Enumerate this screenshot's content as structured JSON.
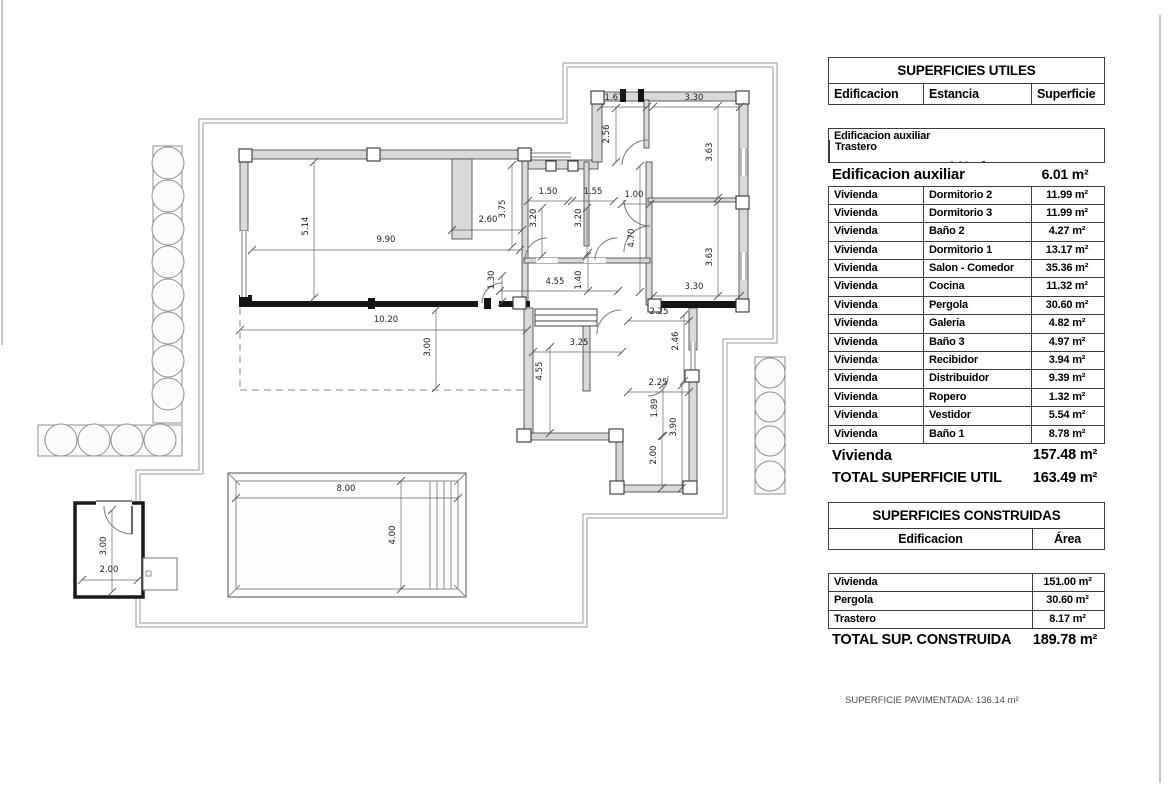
{
  "plan": {
    "dimensions": [
      {
        "t": "1.67",
        "x": 614,
        "y": 100,
        "r": 0,
        "line": [
          601,
          107,
          647,
          107
        ]
      },
      {
        "t": "3.30",
        "x": 694,
        "y": 100,
        "r": 0,
        "line": [
          653,
          107,
          740,
          107
        ]
      },
      {
        "t": "2.56",
        "x": 609,
        "y": 134,
        "r": 90,
        "line": [
          616,
          108,
          616,
          162
        ]
      },
      {
        "t": "3.63",
        "x": 712,
        "y": 152,
        "r": 90,
        "line": [
          718,
          106,
          718,
          198
        ]
      },
      {
        "t": "1.50",
        "x": 548,
        "y": 194,
        "r": 0,
        "line": [
          528,
          201,
          568,
          201
        ]
      },
      {
        "t": "1.55",
        "x": 593,
        "y": 194,
        "r": 0,
        "line": [
          572,
          201,
          614,
          201
        ]
      },
      {
        "t": "1.00",
        "x": 634,
        "y": 197,
        "r": 0,
        "line": [
          622,
          204,
          650,
          204
        ]
      },
      {
        "t": "3.75",
        "x": 505,
        "y": 209,
        "r": 90,
        "line": [
          512,
          165,
          512,
          247
        ]
      },
      {
        "t": "3.20",
        "x": 536,
        "y": 218,
        "r": 90,
        "line": [
          542,
          208,
          542,
          256
        ]
      },
      {
        "t": "3.20",
        "x": 581,
        "y": 218,
        "r": 90,
        "line": [
          587,
          208,
          587,
          256
        ]
      },
      {
        "t": "2.60",
        "x": 488,
        "y": 222,
        "r": 0,
        "line": [
          452,
          230,
          522,
          230
        ]
      },
      {
        "t": "5.14",
        "x": 308,
        "y": 226,
        "r": 90,
        "line": [
          314,
          162,
          314,
          298
        ]
      },
      {
        "t": "4.70",
        "x": 634,
        "y": 238,
        "r": 90,
        "line": [
          640,
          166,
          640,
          292
        ]
      },
      {
        "t": "9.90",
        "x": 386,
        "y": 242,
        "r": 0,
        "line": [
          252,
          250,
          520,
          250
        ]
      },
      {
        "t": "3.63",
        "x": 712,
        "y": 257,
        "r": 90,
        "line": [
          718,
          202,
          718,
          296
        ]
      },
      {
        "t": "1.30",
        "x": 494,
        "y": 280,
        "r": 90,
        "line": [
          502,
          276,
          502,
          302
        ]
      },
      {
        "t": "4.55",
        "x": 555,
        "y": 284,
        "r": 0,
        "line": [
          500,
          291,
          618,
          291
        ]
      },
      {
        "t": "1.40",
        "x": 581,
        "y": 280,
        "r": 90,
        "line": [
          588,
          253,
          588,
          291
        ]
      },
      {
        "t": "3.30",
        "x": 694,
        "y": 289,
        "r": 0,
        "line": [
          653,
          296,
          740,
          296
        ]
      },
      {
        "t": "10.20",
        "x": 386,
        "y": 322,
        "r": 0,
        "line": [
          240,
          330,
          527,
          330
        ]
      },
      {
        "t": "2.25",
        "x": 659,
        "y": 314,
        "r": 0,
        "line": [
          628,
          321,
          689,
          321
        ]
      },
      {
        "t": "3.00",
        "x": 430,
        "y": 347,
        "r": 90,
        "line": [
          436,
          310,
          436,
          388
        ]
      },
      {
        "t": "2.46",
        "x": 678,
        "y": 341,
        "r": 90,
        "line": [
          684,
          315,
          684,
          381
        ]
      },
      {
        "t": "3.25",
        "x": 579,
        "y": 345,
        "r": 0,
        "line": [
          533,
          352,
          622,
          352
        ]
      },
      {
        "t": "4.55",
        "x": 542,
        "y": 371,
        "r": 90,
        "line": [
          550,
          347,
          550,
          433
        ]
      },
      {
        "t": "2.25",
        "x": 658,
        "y": 385,
        "r": 0,
        "line": [
          628,
          392,
          689,
          392
        ]
      },
      {
        "t": "1.89",
        "x": 657,
        "y": 408,
        "r": 90,
        "line": [
          663,
          385,
          663,
          436
        ]
      },
      {
        "t": "3.90",
        "x": 676,
        "y": 427,
        "r": 90,
        "line": [
          682,
          385,
          682,
          488
        ]
      },
      {
        "t": "2.00",
        "x": 656,
        "y": 455,
        "r": 90,
        "line": [
          662,
          436,
          662,
          488
        ]
      },
      {
        "t": "8.00",
        "x": 346,
        "y": 491,
        "r": 0,
        "line": [
          236,
          498,
          458,
          498
        ]
      },
      {
        "t": "4.00",
        "x": 395,
        "y": 535,
        "r": 90,
        "line": [
          401,
          481,
          401,
          589
        ]
      },
      {
        "t": "3.00",
        "x": 106,
        "y": 546,
        "r": 90,
        "line": [
          112,
          510,
          112,
          592
        ]
      },
      {
        "t": "2.00",
        "x": 109,
        "y": 572,
        "r": 0,
        "line": [
          82,
          580,
          138,
          580
        ]
      }
    ]
  },
  "tables": {
    "utiles": {
      "title": "SUPERFICIES UTILES",
      "columns": [
        "Edificacion",
        "Estancia",
        "Superficie"
      ],
      "aux_row": {
        "edificacion": "Edificacion auxiliar",
        "estancia": "Trastero",
        "superficie": "6.01 m²"
      },
      "aux_subtotal": {
        "label": "Edificacion auxiliar",
        "value": "6.01 m²"
      },
      "rows": [
        {
          "edificacion": "Vivienda",
          "estancia": "Dormitorio 2",
          "superficie": "11.99 m²"
        },
        {
          "edificacion": "Vivienda",
          "estancia": "Dormitorio 3",
          "superficie": "11.99 m²"
        },
        {
          "edificacion": "Vivienda",
          "estancia": "Baño 2",
          "superficie": "4.27 m²"
        },
        {
          "edificacion": "Vivienda",
          "estancia": "Dormitorio 1",
          "superficie": "13.17 m²"
        },
        {
          "edificacion": "Vivienda",
          "estancia": "Salon  - Comedor",
          "superficie": "35.36 m²"
        },
        {
          "edificacion": "Vivienda",
          "estancia": "Cocina",
          "superficie": "11.32 m²"
        },
        {
          "edificacion": "Vivienda",
          "estancia": "Pergola",
          "superficie": "30.60 m²"
        },
        {
          "edificacion": "Vivienda",
          "estancia": "Galeria",
          "superficie": "4.82 m²"
        },
        {
          "edificacion": "Vivienda",
          "estancia": "Baño 3",
          "superficie": "4.97 m²"
        },
        {
          "edificacion": "Vivienda",
          "estancia": "Recibidor",
          "superficie": "3.94 m²"
        },
        {
          "edificacion": "Vivienda",
          "estancia": "Distribuidor",
          "superficie": "9.39 m²"
        },
        {
          "edificacion": "Vivienda",
          "estancia": "Ropero",
          "superficie": "1.32 m²"
        },
        {
          "edificacion": "Vivienda",
          "estancia": "Vestidor",
          "superficie": "5.54 m²"
        },
        {
          "edificacion": "Vivienda",
          "estancia": "Baño 1",
          "superficie": "8.78 m²"
        }
      ],
      "vivienda_subtotal": {
        "label": "Vivienda",
        "value": "157.48 m²"
      },
      "total": {
        "label": "TOTAL SUPERFICIE UTIL",
        "value": "163.49 m²"
      }
    },
    "construidas": {
      "title": "SUPERFICIES CONSTRUIDAS",
      "columns": [
        "Edificacion",
        "Área"
      ],
      "rows": [
        {
          "edificacion": "Vivienda",
          "area": "151.00 m²"
        },
        {
          "edificacion": "Pergola",
          "area": "30.60 m²"
        },
        {
          "edificacion": "Trastero",
          "area": "8.17 m²"
        }
      ],
      "total": {
        "label": "TOTAL SUP. CONSTRUIDA",
        "value": "189.78 m²"
      }
    }
  },
  "footer": {
    "paved_note": "SUPERFICIE PAVIMENTADA: 136.14 m²"
  }
}
